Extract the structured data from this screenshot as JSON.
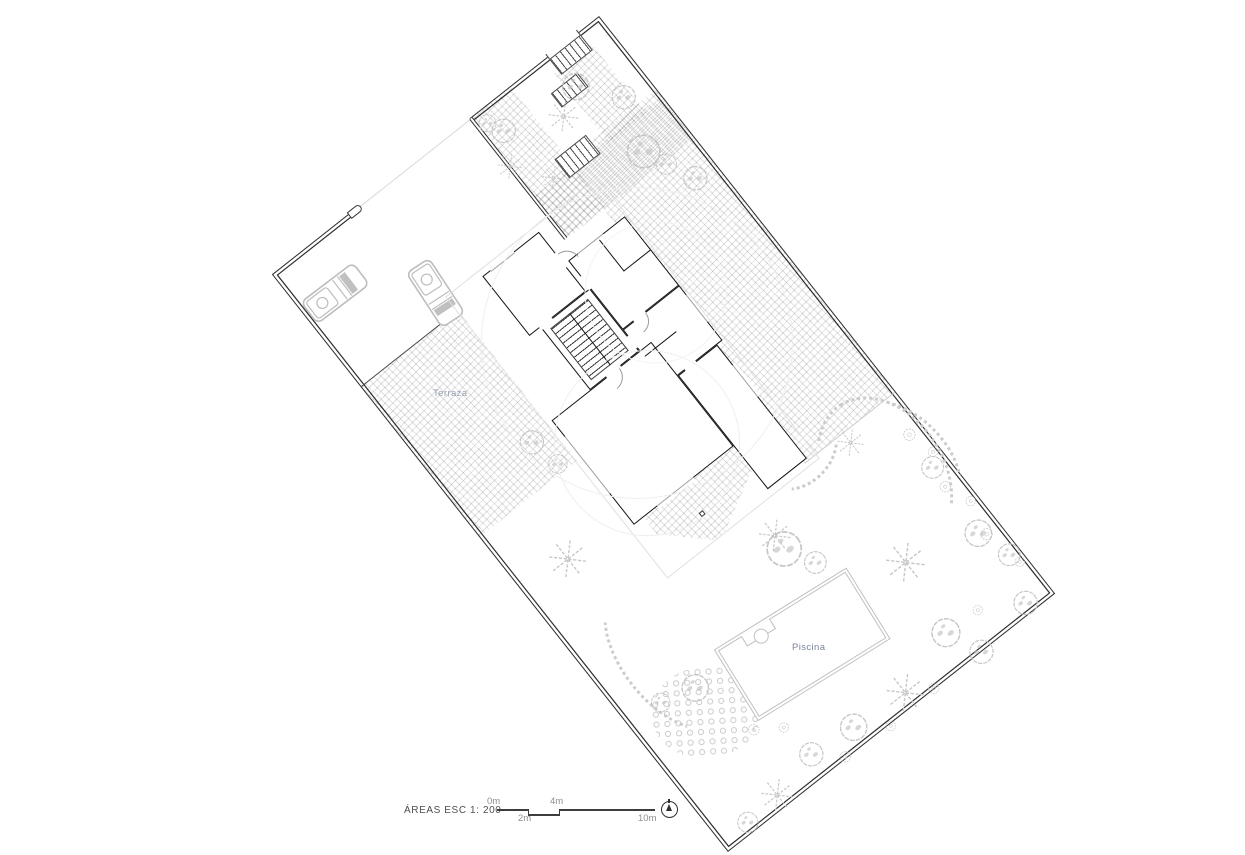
{
  "page": {
    "background": "#ffffff"
  },
  "plan": {
    "labels": {
      "terrace": "Terraza",
      "pool": "Piscina"
    },
    "colors": {
      "boundary": "#2e2e2e",
      "wall": "#141414",
      "tile": "rgba(0,0,0,0.12)",
      "vegetation": "#c6c6c6",
      "pebble": "#cccccc",
      "pool_outline": "#c0c0c0",
      "watermark": "#efefef",
      "terrace_label": "#99a1b0",
      "pool_label": "#79859a"
    },
    "trees": [
      {
        "t": "blob",
        "x": 270,
        "y": 30,
        "s": 30
      },
      {
        "t": "star",
        "x": 253,
        "y": 62,
        "s": 28
      },
      {
        "t": "star",
        "x": 326,
        "y": 56,
        "s": 34
      },
      {
        "t": "blob",
        "x": 354,
        "y": 40,
        "s": 34
      },
      {
        "t": "blob",
        "x": 385,
        "y": 78,
        "s": 30
      },
      {
        "t": "star",
        "x": 280,
        "y": 98,
        "s": 26
      },
      {
        "t": "blob",
        "x": 367,
        "y": 133,
        "s": 42
      },
      {
        "t": "blob",
        "x": 377,
        "y": 157,
        "s": 26
      },
      {
        "t": "blob",
        "x": 391,
        "y": 186,
        "s": 30
      },
      {
        "t": "blob",
        "x": 262,
        "y": 14,
        "s": 22
      },
      {
        "t": "star",
        "x": 349,
        "y": 490,
        "s": 30
      },
      {
        "t": "star",
        "x": 232,
        "y": 516,
        "s": 36
      },
      {
        "t": "blob",
        "x": 99,
        "y": 292,
        "s": 30
      },
      {
        "t": "blob",
        "x": 106,
        "y": 325,
        "s": 24
      },
      {
        "t": "star",
        "x": 55,
        "y": 406,
        "s": 42
      },
      {
        "t": "blob",
        "x": 231,
        "y": 532,
        "s": 44
      },
      {
        "t": "blob",
        "x": 247,
        "y": 562,
        "s": 28
      },
      {
        "t": "blob",
        "x": 75,
        "y": 586,
        "s": 34
      },
      {
        "t": "blob",
        "x": 39,
        "y": 576,
        "s": 24
      },
      {
        "t": "star",
        "x": 318,
        "y": 618,
        "s": 44
      },
      {
        "t": "blob",
        "x": 306,
        "y": 698,
        "s": 36
      },
      {
        "t": "star",
        "x": 237,
        "y": 720,
        "s": 42
      },
      {
        "t": "blob",
        "x": 175,
        "y": 715,
        "s": 34
      },
      {
        "t": "blob",
        "x": 125,
        "y": 710,
        "s": 30
      },
      {
        "t": "star",
        "x": 73,
        "y": 721,
        "s": 36
      },
      {
        "t": "blob",
        "x": 33,
        "y": 724,
        "s": 26
      },
      {
        "t": "blob",
        "x": 322,
        "y": 735,
        "s": 30
      },
      {
        "t": "blob",
        "x": 393,
        "y": 640,
        "s": 34
      },
      {
        "t": "blob",
        "x": 404,
        "y": 676,
        "s": 28
      },
      {
        "t": "blob",
        "x": 387,
        "y": 724,
        "s": 30
      },
      {
        "t": "blob",
        "x": 398,
        "y": 560,
        "s": 28
      }
    ],
    "shrubs": [
      {
        "x": 400,
        "y": 520,
        "s": 24
      },
      {
        "x": 408,
        "y": 548,
        "s": 20
      },
      {
        "x": 396,
        "y": 583,
        "s": 22
      },
      {
        "x": 407,
        "y": 610,
        "s": 20
      },
      {
        "x": 399,
        "y": 646,
        "s": 24
      },
      {
        "x": 408,
        "y": 688,
        "s": 20
      },
      {
        "x": 150,
        "y": 733,
        "s": 22
      },
      {
        "x": 205,
        "y": 737,
        "s": 20
      },
      {
        "x": 262,
        "y": 734,
        "s": 22
      },
      {
        "x": 95,
        "y": 655,
        "s": 22
      },
      {
        "x": 120,
        "y": 672,
        "s": 20
      },
      {
        "x": 345,
        "y": 700,
        "s": 20
      }
    ]
  },
  "legend": {
    "title": "ÁREAS  ESC 1: 200",
    "marks": [
      "0m",
      "2m",
      "4m",
      "10m"
    ]
  }
}
